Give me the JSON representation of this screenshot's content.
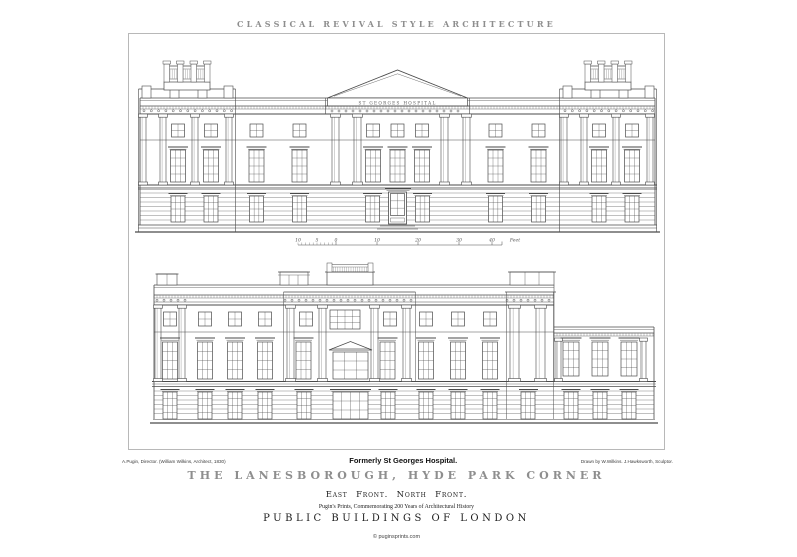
{
  "header": {
    "title": "CLASSICAL REVIVAL STYLE ARCHITECTURE"
  },
  "plate": {
    "east_front": {
      "frieze_inscription": "ST GEORGES HOSPITAL",
      "scale_bar": {
        "labels": [
          "10",
          "5",
          "0",
          "10",
          "20",
          "30",
          "40"
        ],
        "unit": "Feet"
      }
    },
    "north_front": {}
  },
  "captions": {
    "left_credit": "A.Pugin, Director. (William Wilkins, Architect, 1830)",
    "center_caption": "Formerly St Georges Hospital.",
    "right_credit": "Drawn by W.Wilkins. J.Hawksworth, Sculptor.",
    "main_title": "THE LANESBOROUGH, HYDE PARK CORNER",
    "fronts": "East Front. North Front.",
    "series_note": "Pugin's Prints, Commemorating 200 Years of Architectural History",
    "series_title": "PUBLIC BUILDINGS OF LONDON"
  },
  "footer": {
    "copyright": "© puginsprints.com"
  },
  "colors": {
    "paper": "#ffffff",
    "line": "#4a4a4a",
    "muted_gray": "#8e8e8e",
    "ink": "#1d1d1d"
  }
}
